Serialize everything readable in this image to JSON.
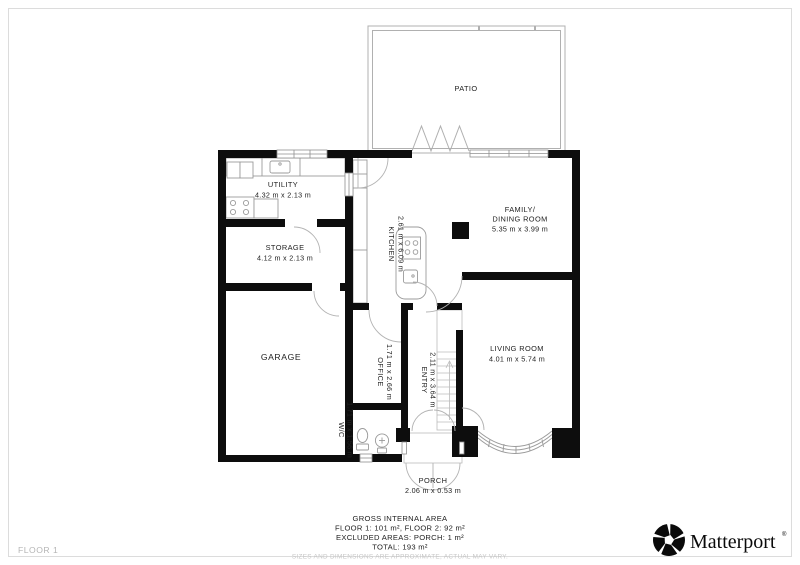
{
  "rooms": {
    "patio": {
      "name": "PATIO"
    },
    "utility": {
      "name": "UTILITY",
      "dims": "4.32 m x 2.13 m"
    },
    "storage": {
      "name": "STORAGE",
      "dims": "4.12 m x 2.13 m"
    },
    "kitchen": {
      "name": "KITCHEN",
      "dims": "2.61 m x 6.09 m"
    },
    "family_dining": {
      "name_line1": "FAMILY/",
      "name_line2": "DINING ROOM",
      "dims": "5.35 m x 3.99 m"
    },
    "living": {
      "name": "LIVING ROOM",
      "dims": "4.01 m x 5.74 m"
    },
    "garage": {
      "name": "GARAGE"
    },
    "office": {
      "name": "OFFICE",
      "dims": "1.71 m x 2.66 m"
    },
    "entry": {
      "name": "ENTRY",
      "dims": "2.11 m x 3.64 m"
    },
    "wc": {
      "name": "W/C",
      "dims": "1.71 m x 1.56 m"
    },
    "porch": {
      "name": "PORCH",
      "dims": "2.06 m x 0.53 m"
    }
  },
  "footer": {
    "title": "GROSS INTERNAL AREA",
    "line1": "FLOOR 1: 101 m², FLOOR 2: 92 m²",
    "line2": "EXCLUDED AREAS: PORCH: 1 m²",
    "line3": "TOTAL: 193 m²",
    "disclaimer": "SIZES AND DIMENSIONS ARE APPROXIMATE, ACTUAL MAY VARY."
  },
  "status_bar": {
    "floor_label": "FLOOR 1"
  },
  "brand": {
    "wordmark": "Matterport",
    "registered": "®"
  },
  "colors": {
    "wall": "#0d0d0d",
    "fixture_stroke": "#9b9b9b",
    "patio_outline": "#b0b0b0",
    "label_text": "#222222",
    "muted_text": "#c6c6c6",
    "floor_label_text": "#b5b5b5",
    "background": "#ffffff"
  }
}
